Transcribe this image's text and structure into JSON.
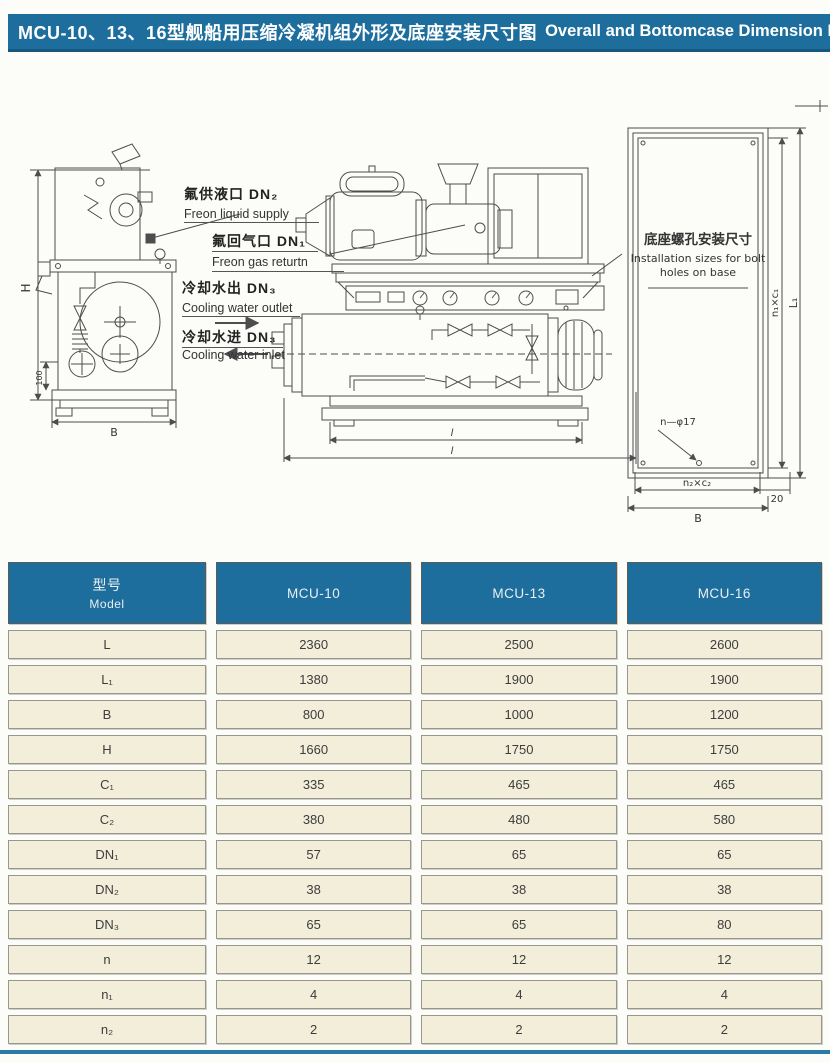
{
  "header": {
    "title_zh": "MCU-10、13、16型舰船用压缩冷凝机组外形及底座安装尺寸图",
    "title_en": "Overall and Bottomcase Dimension  Diagram"
  },
  "colors": {
    "accent_teal": "#1e6e9d",
    "cell_cream": "#f2eed9",
    "drawing_line": "#4d4d4d"
  },
  "drawings": {
    "callouts": [
      {
        "zh": "氟供液口 DN₂",
        "en": "Freon liquid supply"
      },
      {
        "zh": "氟回气口 DN₁",
        "en": "Freon  gas returtn"
      },
      {
        "zh": "冷却水出 DN₃",
        "en": "Cooling water outlet"
      },
      {
        "zh": "冷却水进 DN₃",
        "en": "Cooling water inlet"
      }
    ],
    "left_view": {
      "dim_h": "H",
      "dim_100": "100",
      "dim_b": "B"
    },
    "front_view": {
      "dim_inner": "l",
      "dim_outer": "l"
    },
    "base_plan": {
      "label_zh": "底座螺孔安装尺寸",
      "label_en_1": "Installation sizes for bolt",
      "label_en_2": "holes on base",
      "bolt_note": "n—φ17",
      "dim_bottom_inner": "n₂×c₂",
      "dim_bottom_outer": "B",
      "dim_right_inner": "n₁×c₁",
      "dim_right_outer": "L₁",
      "dim_edge": "20"
    }
  },
  "table": {
    "header": {
      "model_zh": "型号",
      "model_en": "Model",
      "columns": [
        "MCU-10",
        "MCU-13",
        "MCU-16"
      ]
    },
    "rows": [
      {
        "label": "L",
        "values": [
          "2360",
          "2500",
          "2600"
        ]
      },
      {
        "label": "L₁",
        "values": [
          "1380",
          "1900",
          "1900"
        ]
      },
      {
        "label": "B",
        "values": [
          "800",
          "1000",
          "1200"
        ]
      },
      {
        "label": "H",
        "values": [
          "1660",
          "1750",
          "1750"
        ]
      },
      {
        "label": "C₁",
        "values": [
          "335",
          "465",
          "465"
        ]
      },
      {
        "label": "C₂",
        "values": [
          "380",
          "480",
          "580"
        ]
      },
      {
        "label": "DN₁",
        "values": [
          "57",
          "65",
          "65"
        ]
      },
      {
        "label": "DN₂",
        "values": [
          "38",
          "38",
          "38"
        ]
      },
      {
        "label": "DN₃",
        "values": [
          "65",
          "65",
          "80"
        ]
      },
      {
        "label": "n",
        "values": [
          "12",
          "12",
          "12"
        ]
      },
      {
        "label": "n₁",
        "values": [
          "4",
          "4",
          "4"
        ]
      },
      {
        "label": "n₂",
        "values": [
          "2",
          "2",
          "2"
        ]
      }
    ]
  }
}
